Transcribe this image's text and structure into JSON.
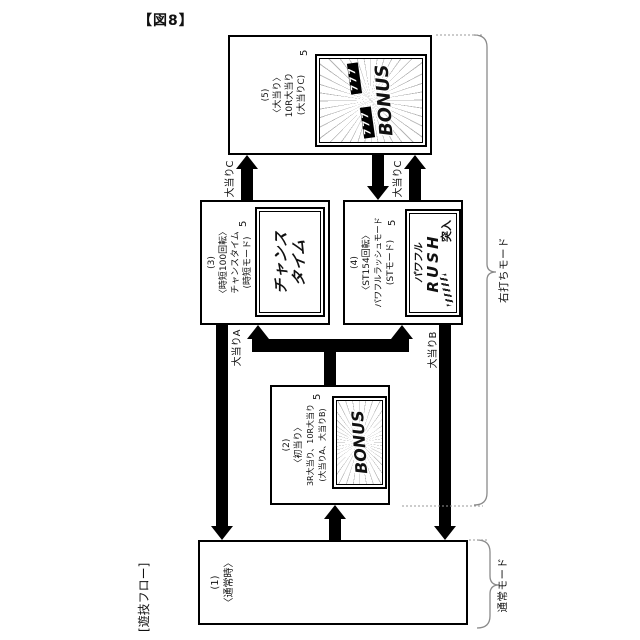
{
  "figure": {
    "number": "【図8】",
    "flow_label": "[遊技フロー]",
    "ref_numeral": "5"
  },
  "boxes": {
    "normal": {
      "no": "(1)",
      "title": "〈通常時〉"
    },
    "first_hit": {
      "no": "(2)",
      "title": "〈初当り〉",
      "sub1": "3R大当り、10R大当り",
      "sub2": "(大当りA、大当りB)",
      "screen": {
        "logo": "BONUS"
      }
    },
    "chance_time": {
      "no": "(3)",
      "title": "〈時短100回転〉",
      "sub1": "チャンスタイム",
      "sub2": "(時短モード)",
      "screen": {
        "line1": "チャンス",
        "line2": "タイム"
      }
    },
    "powerful_rush": {
      "no": "(4)",
      "title": "〈ST154回転〉",
      "sub1": "パワフルラッシュモード",
      "sub2": "(STモード)",
      "screen": {
        "line1": "パワフル",
        "line2": "RUSH",
        "line3": "突入"
      }
    },
    "jackpot": {
      "no": "(5)",
      "title": "〈大当り〉",
      "sub1": "10R大当り",
      "sub2": "(大当りC)",
      "screen": {
        "reel1": "777",
        "reel2": "777",
        "logo": "BONUS"
      }
    }
  },
  "arrow_labels": {
    "a": "大当りA",
    "b": "大当りB",
    "c_upper": "大当りC",
    "c_lower": "大当りC"
  },
  "mode_brackets": {
    "right_strike": "右打ちモード",
    "normal": "通常モード"
  },
  "colors": {
    "ink": "#000000",
    "brace": "#8a8a8a",
    "background": "#ffffff"
  }
}
